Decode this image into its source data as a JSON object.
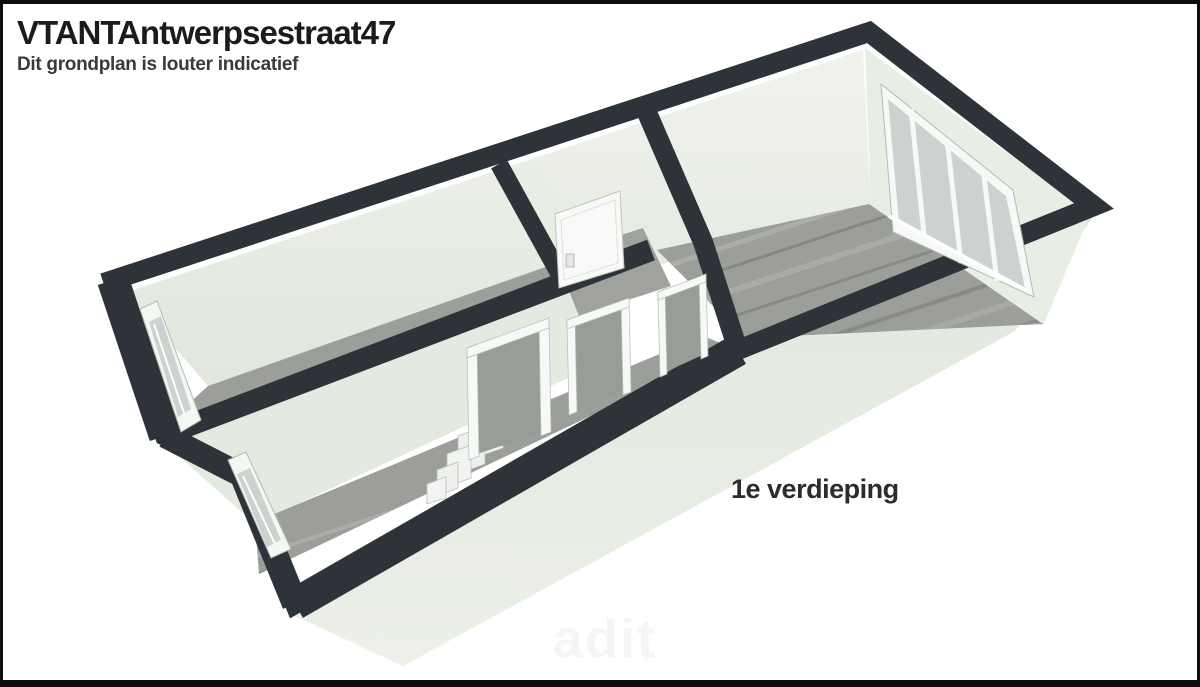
{
  "header": {
    "title": "VTANTAntwerpsestraat47",
    "subtitle": "Dit grondplan is louter indicatief"
  },
  "plan": {
    "type": "3d-floorplan-isometric",
    "floor_label": "1e verdieping",
    "watermark": "adit"
  },
  "colors": {
    "background": "#ffffff",
    "border": "#0d0d0d",
    "wall_cut": "#2d3338",
    "exterior_wall": "#e6ebe2",
    "exterior_wall_shade": "#dde4d9",
    "interior_wall": "#eef1e9",
    "interior_wall_shade": "#e4eadf",
    "floor_wood": "#9b9e99",
    "floor_wood_light": "#aaada7",
    "glass": "#ccd3cf",
    "frame_white": "#f7f9f6",
    "frame_outline": "#b3b9b3",
    "title_text": "#1b1b1b",
    "subtitle_text": "#3a3a3a",
    "label_text": "#2c2c2c",
    "watermark_text": "#f4f6f3"
  }
}
